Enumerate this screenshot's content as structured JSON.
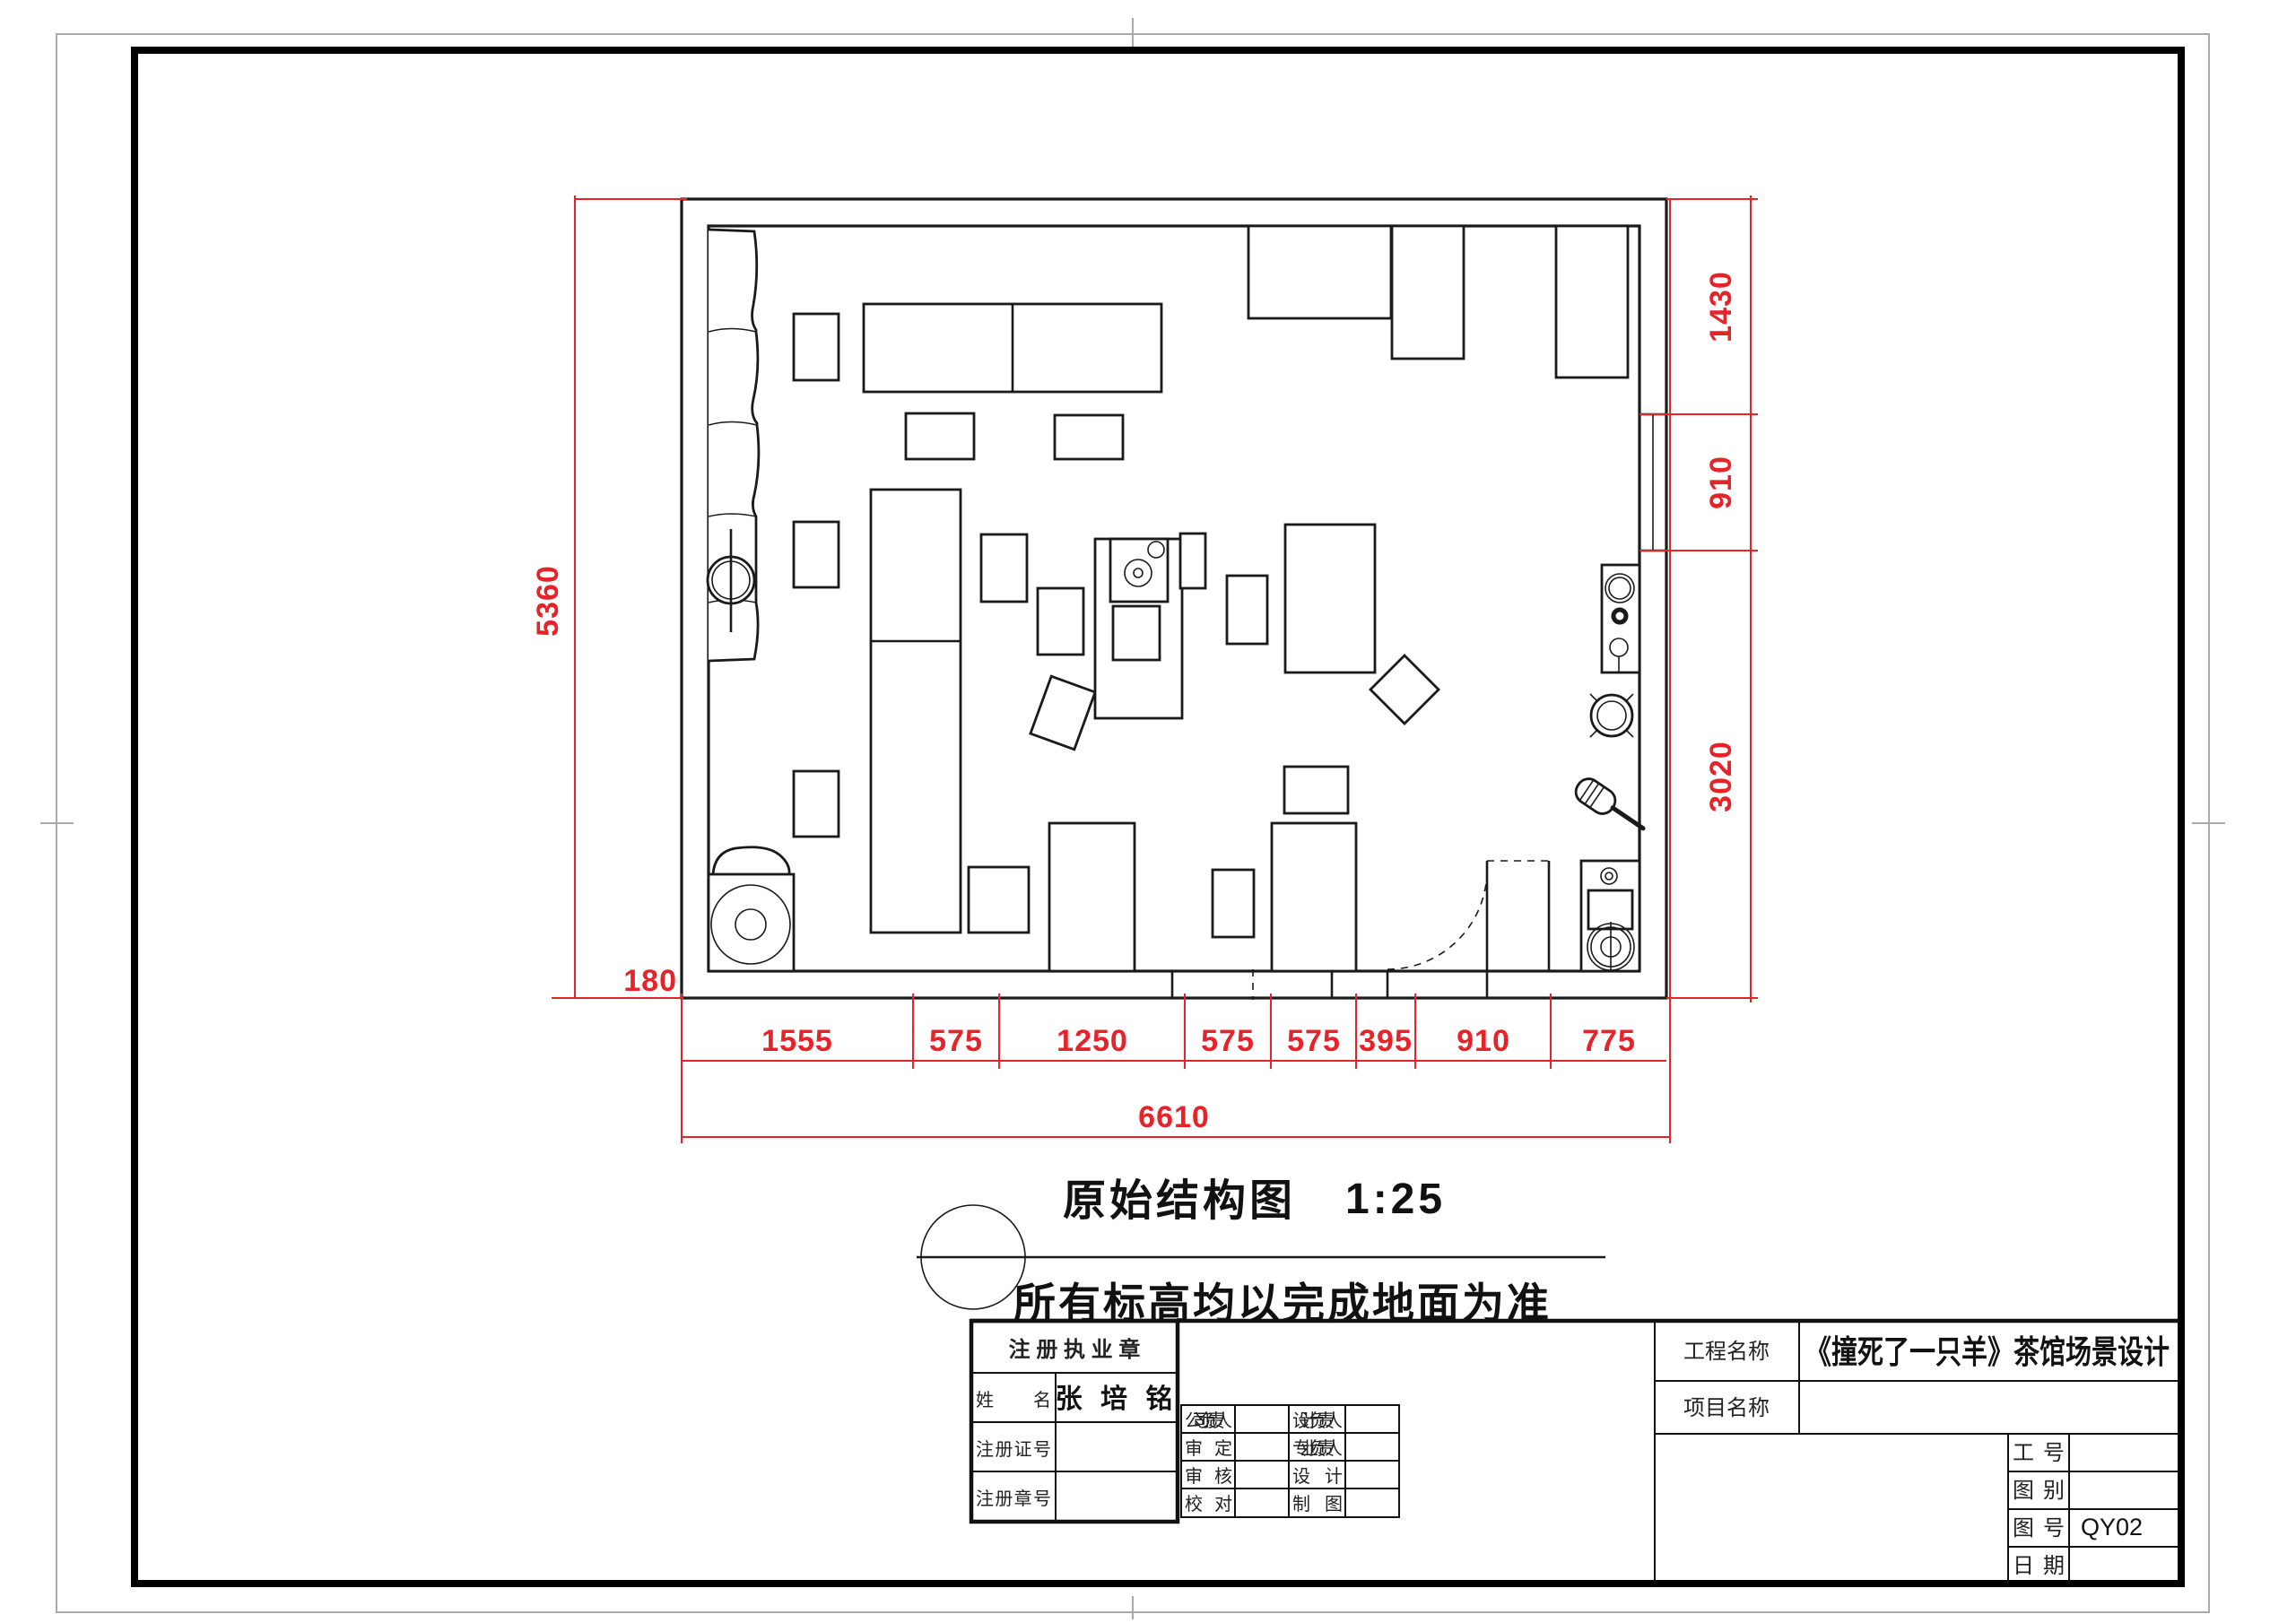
{
  "colors": {
    "dim_red": "#e62329",
    "line_black": "#1a1a1a"
  },
  "drawing_title": {
    "name": "原始结构图",
    "scale": "1:25",
    "note": "所有标高均以完成地面为准"
  },
  "dimensions": {
    "left_total": "5360",
    "wall_offset": "180",
    "bottom_segments": [
      "1555",
      "575",
      "1250",
      "575",
      "575",
      "395",
      "910",
      "775"
    ],
    "bottom_total": "6610",
    "right_segments": [
      "1430",
      "910",
      "3020"
    ]
  },
  "title_block": {
    "seal": {
      "header": "注 册 执 业 章",
      "rows": [
        {
          "label": "姓        名",
          "value": "张 培 铭"
        },
        {
          "label": "注 册 证 号",
          "value": ""
        },
        {
          "label": "注 册 章 号",
          "value": ""
        }
      ]
    },
    "approval_rows": [
      {
        "l": "公司负责人",
        "r": "设计负责人"
      },
      {
        "l": "审      定",
        "r": "专业负责人"
      },
      {
        "l": "审      核",
        "r": "设      计"
      },
      {
        "l": "校      对",
        "r": "制      图"
      }
    ],
    "project": {
      "rows": [
        {
          "label": "工程名称",
          "value": "《撞死了一只羊》茶馆场景设计"
        },
        {
          "label": "项目名称",
          "value": ""
        }
      ]
    },
    "info": {
      "rows": [
        {
          "label": "工    号",
          "value": ""
        },
        {
          "label": "图    别",
          "value": ""
        },
        {
          "label": "图    号",
          "value": "QY02"
        },
        {
          "label": "日    期",
          "value": ""
        }
      ]
    }
  }
}
